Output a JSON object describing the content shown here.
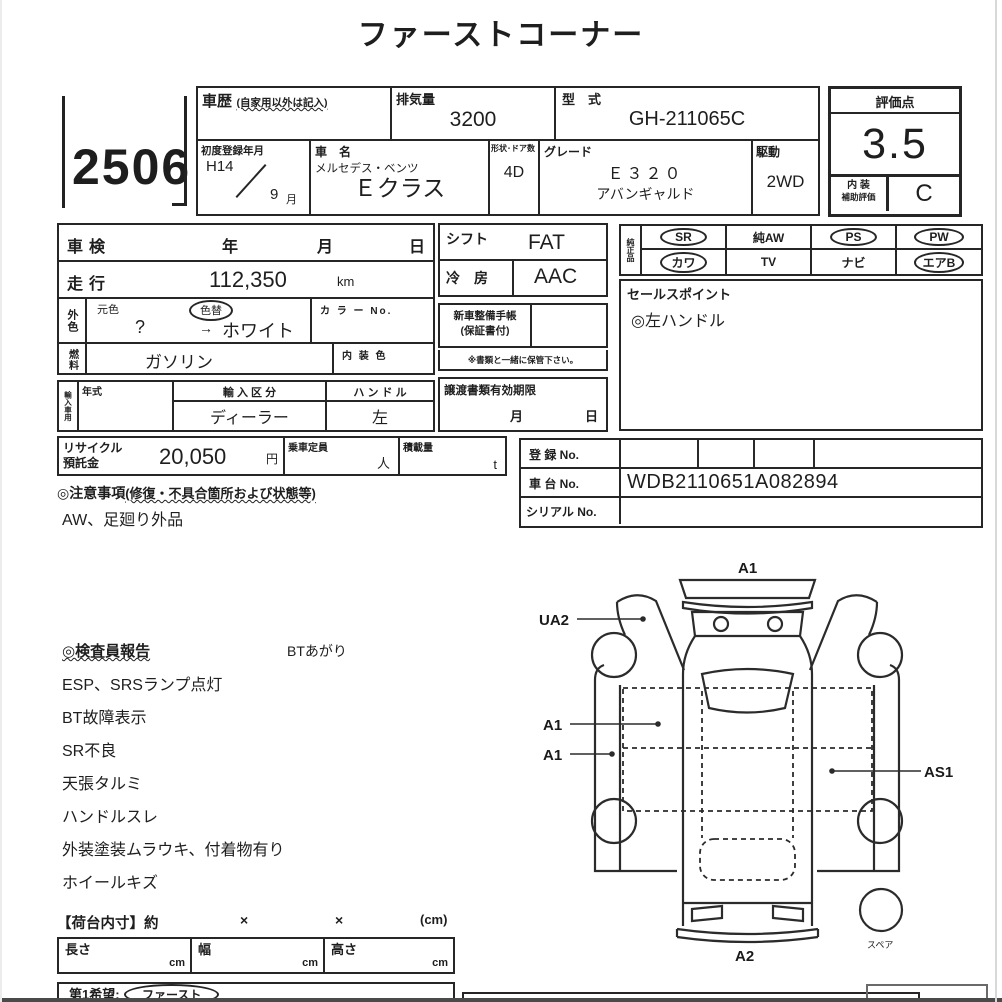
{
  "title": "ファーストコーナー",
  "lot": {
    "number": "2506"
  },
  "header": {
    "history_label": "車歴",
    "history_note": "(自家用以外は記入)",
    "displacement_label": "排気量",
    "displacement_value": "3200",
    "model_code_label": "型　式",
    "model_code_value": "GH-211065C",
    "first_reg_label": "初度登録年月",
    "first_reg_era": "H14",
    "first_reg_month": "9",
    "first_reg_month_suffix": "月",
    "name_label": "車　名",
    "maker": "メルセデス・ベンツ",
    "model": "Ｅクラス",
    "shape_doors_label": "形状･ドア数",
    "shape_doors_value": "4D",
    "grade_label": "グレード",
    "grade_line1": "Ｅ３２０",
    "grade_line2": "アバンギャルド",
    "drive_label": "駆動",
    "drive_value": "2WD"
  },
  "evaluation": {
    "score_label": "評価点",
    "score_value": "3.5",
    "interior_label_line1": "内 装",
    "interior_label_line2": "補助評価",
    "interior_grade": "C"
  },
  "left_table": {
    "shaken_label": "車検",
    "year": "年",
    "month": "月",
    "day": "日",
    "mileage_label": "走行",
    "mileage_value": "112,350",
    "mileage_unit": "km",
    "ext_color_label": "外色",
    "orig_color_label": "元色",
    "color_change_label": "色替",
    "orig_color_value": "?",
    "arrow": "→",
    "current_color": "ホワイト",
    "color_no_label": "カ ラ ー No.",
    "fuel_label": "燃料",
    "fuel_value": "ガソリン",
    "interior_color_label": "内 装 色"
  },
  "mid_table": {
    "shift_label": "シフト",
    "shift_value": "FAT",
    "ac_label": "冷　房",
    "ac_value": "AAC",
    "handbook_line1": "新車整備手帳",
    "handbook_line2": "(保証書付)",
    "handbook_note": "※書類と一緒に保管下さい。",
    "transfer_label": "譲渡書類有効期限",
    "transfer_month": "月",
    "transfer_day": "日"
  },
  "equipment": {
    "label": "純正品",
    "row1": [
      {
        "label": "SR",
        "circled": true
      },
      {
        "label": "純AW",
        "circled": false
      },
      {
        "label": "PS",
        "circled": true
      },
      {
        "label": "PW",
        "circled": true
      }
    ],
    "row2": [
      {
        "label": "カワ",
        "circled": true
      },
      {
        "label": "TV",
        "circled": false
      },
      {
        "label": "ナビ",
        "circled": false
      },
      {
        "label": "エアB",
        "circled": true
      }
    ]
  },
  "sales_point": {
    "label": "セールスポイント",
    "value": "◎左ハンドル"
  },
  "import_block": {
    "label": "輸入車用",
    "year_label": "年式",
    "division_label": "輸 入 区 分",
    "division_value": "ディーラー",
    "handle_label": "ハ ン ド ル",
    "handle_value": "左"
  },
  "recycle": {
    "label_line1": "リサイクル",
    "label_line2": "預託金",
    "value": "20,050",
    "unit": "円",
    "capacity_label": "乗車定員",
    "capacity_unit": "人",
    "load_label": "積載量",
    "load_unit": "t"
  },
  "registration": {
    "reg_label": "登 録 No.",
    "chassis_label": "車 台 No.",
    "chassis_value": "WDB2110651A082894",
    "serial_label": "シリアル No."
  },
  "notes": {
    "header_left": "◎注意事項",
    "header_paren": "(修復・不具合箇所および状態等)",
    "body": "AW、足廻り外品"
  },
  "inspector_report": {
    "header": "◎検査員報告",
    "side_note": "BTあがり",
    "lines": [
      "ESP、SRSランプ点灯",
      "BT故障表示",
      "SR不良",
      "天張タルミ",
      "ハンドルスレ",
      "外装塗装ムラウキ、付着物有り",
      "ホイールキズ"
    ]
  },
  "cargo": {
    "header": "【荷台内寸】約",
    "times": "×",
    "unit": "(cm)",
    "length_label": "長さ",
    "width_label": "幅",
    "height_label": "高さ",
    "cm": "cm"
  },
  "bottom": {
    "wish_label": "第1希望:",
    "wish_value": "ファースト"
  },
  "diagram": {
    "front_label": "A1",
    "left_fender_label": "UA2",
    "left_door_label_1": "A1",
    "left_door_label_2": "A1",
    "right_rear_label": "AS1",
    "rear_label": "A2",
    "spare_label": "スペア"
  }
}
